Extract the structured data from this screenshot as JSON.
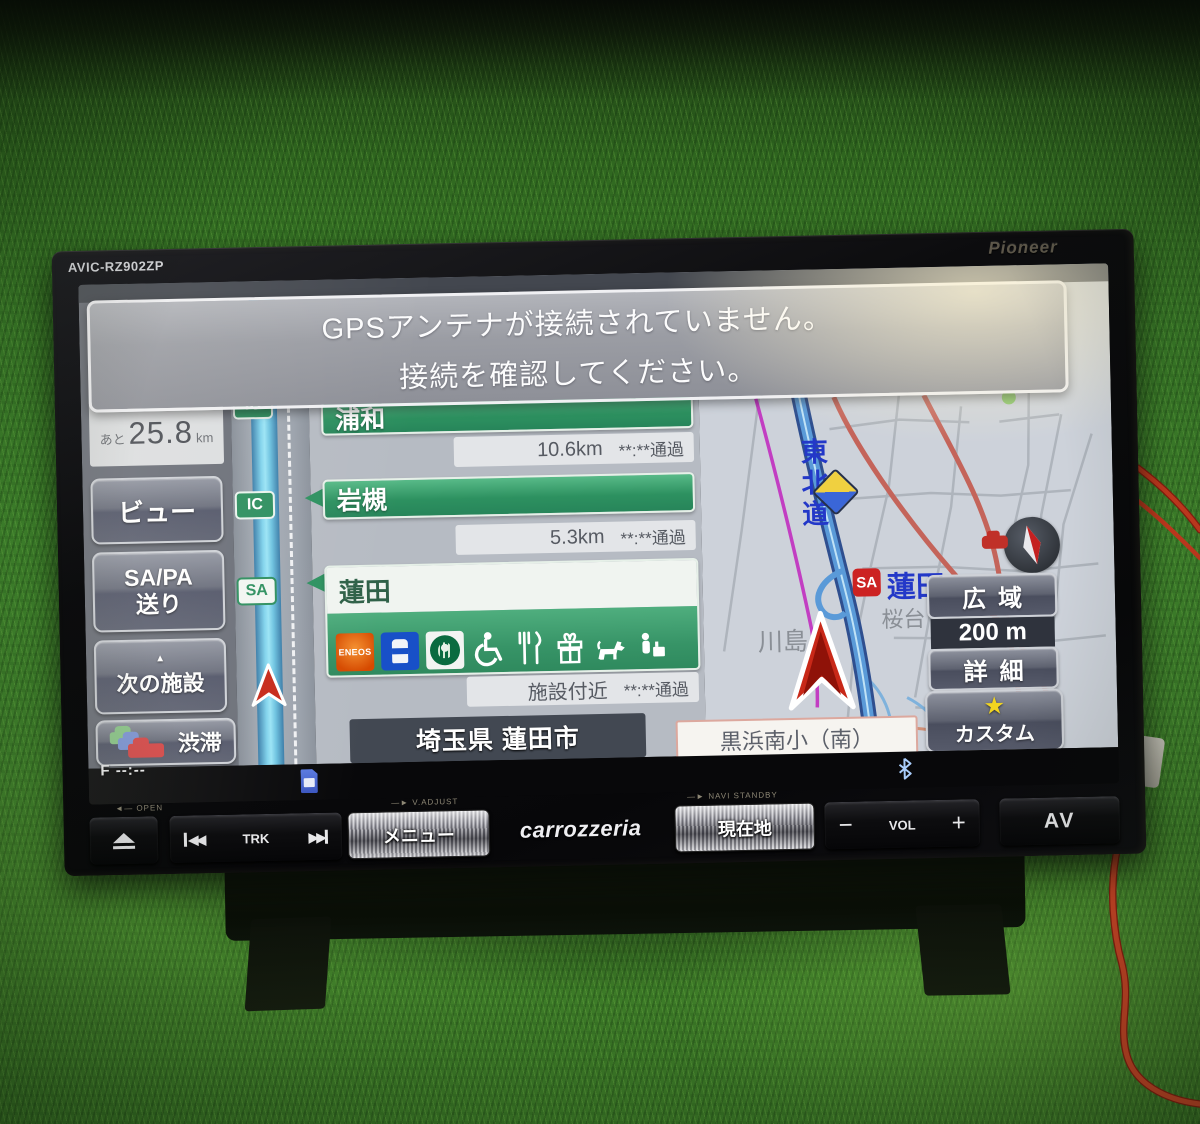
{
  "ui": {
    "caret_up": "▲",
    "star": "★",
    "prev_glyph": "◀◀",
    "next_glyph": "▶▶"
  },
  "device": {
    "model": "AVIC-RZ902ZP",
    "brand": "Pioneer",
    "logo": "carrozzeria",
    "panel_labels": {
      "open": "OPEN",
      "v_adjust": "V.ADJUST",
      "navi_standby": "NAVI STANDBY"
    },
    "buttons": {
      "trk": "TRK",
      "menu": "メニュー",
      "current_location": "現在地",
      "minus": "−",
      "vol": "VOL",
      "plus": "+",
      "av": "AV"
    }
  },
  "screen": {
    "dialog": {
      "line1": "GPSアンテナが接続されていません。",
      "line2": "接続を確認してください。"
    },
    "sidebar": {
      "remaining_prefix": "あと",
      "remaining_value": "25.8",
      "remaining_unit": "km",
      "view": "ビュー",
      "sapa_line1": "SA/PA",
      "sapa_line2": "送り",
      "next_facility": "次の施設",
      "traffic": "渋滞",
      "traffic_time": "F --:--"
    },
    "highway": {
      "ic_badge": "IC",
      "sa_badge": "SA",
      "exits": [
        {
          "name": "浦和",
          "distance": "10.6km",
          "pass": "**:**通過"
        },
        {
          "name": "岩槻",
          "distance": "5.3km",
          "pass": "**:**通過"
        },
        {
          "name": "蓮田",
          "distance": "施設付近",
          "pass": "**:**通過"
        }
      ],
      "facilities": [
        "ENEOS",
        "LAWSON",
        "Starbucks",
        "wheelchair",
        "restaurant",
        "gift-shop",
        "dog-run",
        "rest-area"
      ],
      "eneos_text": "ENEOS",
      "location_bar": "埼玉県 蓮田市"
    },
    "map": {
      "expressway_label": "東北道",
      "sa_badge": "SA",
      "sa_name": "蓮田",
      "place_sakuradai": "桜台",
      "place_kawashima": "川島",
      "intersection_label": "黒浜南小（南）",
      "zoom_out": "広域",
      "scale": "200 m",
      "zoom_in": "詳細",
      "custom": "カスタム"
    }
  },
  "colors": {
    "exit_bar_green": "#2d9160",
    "route_magenta": "#c23ec2",
    "expressway_blue": "#5a9ad8",
    "position_red": "#c62818",
    "dialog_gray": "#9b9da4",
    "custom_star_yellow": "#f2d520",
    "cable_red": "#d23c20"
  }
}
